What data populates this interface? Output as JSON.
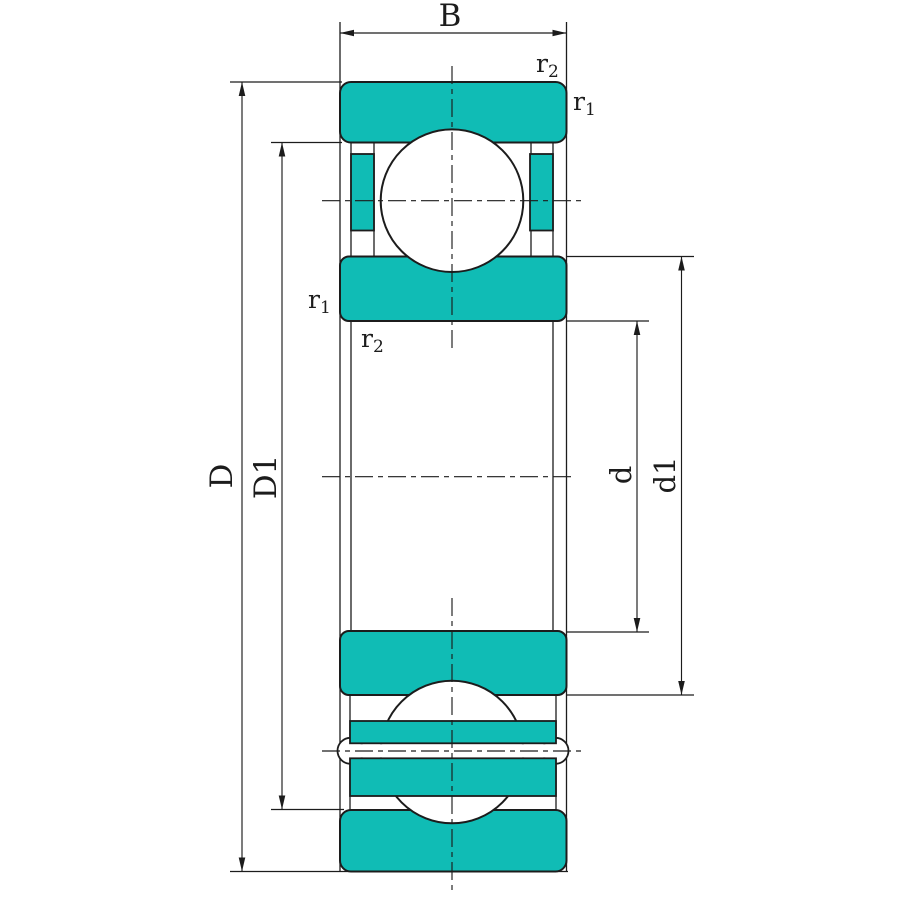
{
  "colors": {
    "part_fill": "#10bcb5",
    "line": "#1c1c1c",
    "background": "#ffffff"
  },
  "dimensions": {
    "width_label": "B",
    "outer_diameter_label": "D",
    "outer_race_inner_diameter_label": "D1",
    "bore_diameter_label": "d",
    "inner_race_outer_diameter_label": "d1"
  },
  "fillets": {
    "r_base": "r",
    "r1_subscript": "1",
    "r2_subscript": "2"
  }
}
